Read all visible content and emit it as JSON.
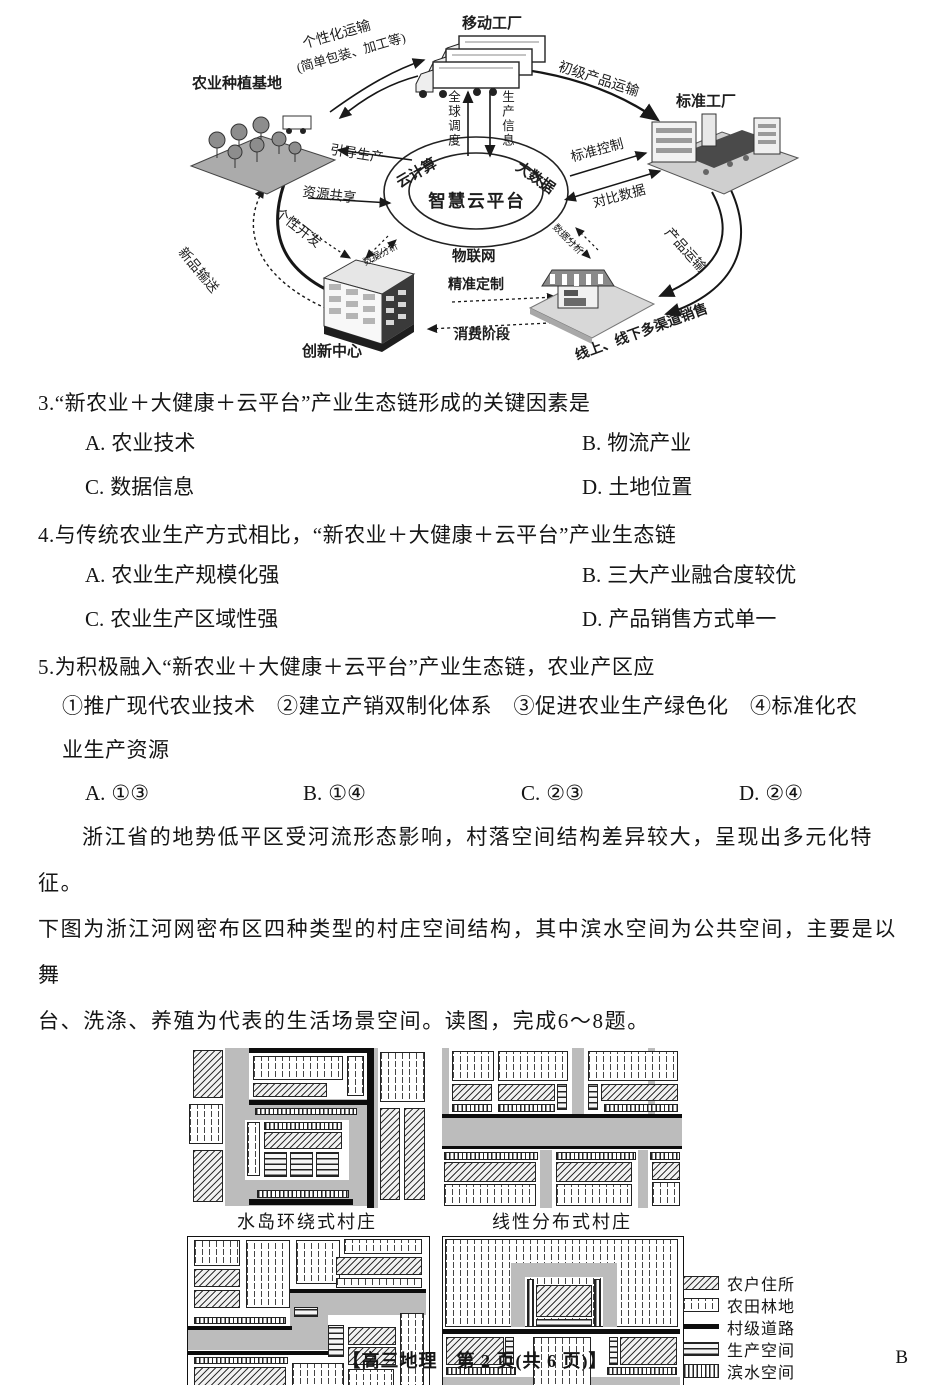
{
  "eco": {
    "nodes": {
      "base": "农业种植基地",
      "mobile": "移动工厂",
      "standard": "标准工厂",
      "innovation": "创新中心"
    },
    "ring": {
      "center": "智慧云平台",
      "cloud": "云计算",
      "bigdata": "大数据",
      "iot": "物联网"
    },
    "flows": {
      "personal_transport": "个性化运输",
      "personal_note": "(简单包装、加工等)",
      "primary_transport": "初级产品运输",
      "global_dispatch": "全球调度",
      "production_info": "生产信息",
      "guide_production": "引导生产",
      "resource_share": "资源共享",
      "standard_control": "标准控制",
      "compare_data": "对比数据",
      "personal_dev": "个性开发",
      "new_product": "新品输送",
      "data_analysis_left": "数据分析",
      "data_analysis_right": "数据分析",
      "precise_custom": "精准定制",
      "consume_stage": "消费阶段",
      "product_transport": "产品运输",
      "sales": "线上、线下多渠道销售"
    }
  },
  "questions": {
    "q3": {
      "stem": "3.“新农业＋大健康＋云平台”产业生态链形成的关键因素是",
      "options": [
        {
          "label": "A.",
          "text": "农业技术"
        },
        {
          "label": "B.",
          "text": "物流产业"
        },
        {
          "label": "C.",
          "text": "数据信息"
        },
        {
          "label": "D.",
          "text": "土地位置"
        }
      ]
    },
    "q4": {
      "stem": "4.与传统农业生产方式相比，“新农业＋大健康＋云平台”产业生态链",
      "options": [
        {
          "label": "A.",
          "text": "农业生产规模化强"
        },
        {
          "label": "B.",
          "text": "三大产业融合度较优"
        },
        {
          "label": "C.",
          "text": "农业生产区域性强"
        },
        {
          "label": "D.",
          "text": "产品销售方式单一"
        }
      ]
    },
    "q5": {
      "stem": "5.为积极融入“新农业＋大健康＋云平台”产业生态链，农业产区应",
      "items_line1": "①推广现代农业技术　②建立产销双制化体系　③促进农业生产绿色化　④标准化农",
      "items_line2": "业生产资源",
      "options": [
        {
          "label": "A.",
          "text": "①③"
        },
        {
          "label": "B.",
          "text": "①④"
        },
        {
          "label": "C.",
          "text": "②③"
        },
        {
          "label": "D.",
          "text": "②④"
        }
      ]
    }
  },
  "passage": {
    "line1": "浙江省的地势低平区受河流形态影响，村落空间结构差异较大，呈现出多元化特征。",
    "line2": "下图为浙江河网密布区四种类型的村庄空间结构，其中滨水空间为公共空间，主要是以舞",
    "line3": "台、洗涤、养殖为代表的生活场景空间。读图，完成6～8题。"
  },
  "village": {
    "captions": [
      "水岛环绕式村庄",
      "线性分布式村庄",
      "水脉交汇式村庄",
      "水系穿插式村庄"
    ],
    "legend": [
      "农户住所",
      "农田林地",
      "村级道路",
      "生产空间",
      "滨水空间",
      "河流"
    ],
    "colors": {
      "river": "#bcbcbc",
      "road": "#111111"
    }
  },
  "footer": {
    "center": "【高三地理　第 2 页(共 6 页)】",
    "right": "B"
  }
}
